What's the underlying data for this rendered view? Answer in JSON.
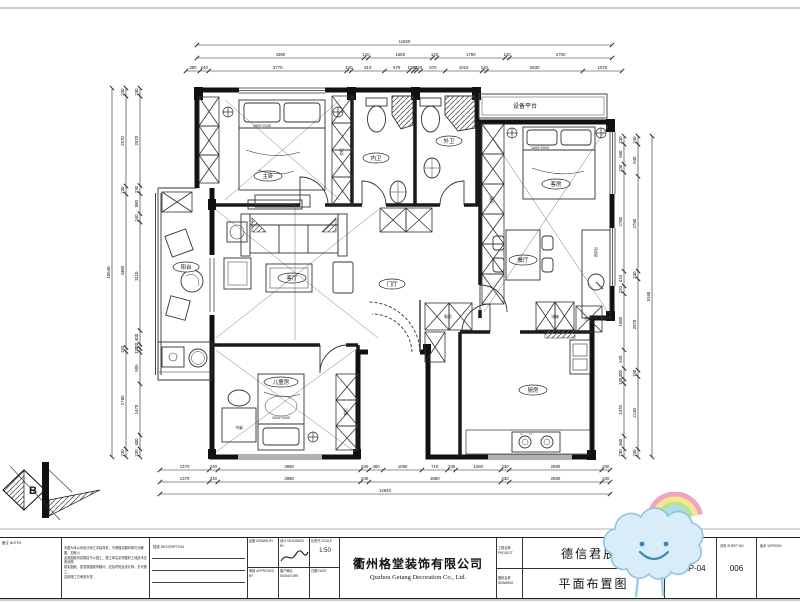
{
  "rooms": {
    "master": "主卧",
    "bath_in": "内卫",
    "bath_out": "外卫",
    "guest": "客房",
    "dining": "餐厅",
    "foyer": "门厅",
    "living": "客厅",
    "balcony": "阳台",
    "kids": "儿童房",
    "kitchen": "厨房",
    "equipment": "设备平台"
  },
  "furniture": {
    "master_bed_size": "1800*2100",
    "guest_bed_size": "1800*2000",
    "kids_bed_size": "1500*2000",
    "wardrobe": "衣柜",
    "desk": "书桌",
    "fridge": "冰箱",
    "shoe_cabinet": "鞋柜",
    "west_kitchen": "西厨台",
    "washer": "洗衣机"
  },
  "compass": {
    "letter": "B"
  },
  "dimensions": {
    "top": [
      [
        "11920"
      ],
      [
        "4390",
        "120",
        "1680",
        "120",
        "1790",
        "120",
        "2700"
      ],
      [
        "380",
        "240",
        "3770",
        "120",
        "910",
        "670",
        "120",
        "80",
        "120",
        "670",
        "1010",
        "120",
        "2630",
        "1070"
      ]
    ],
    "bottom": [
      [
        "1370",
        "240",
        "3980",
        "230",
        "400",
        "1080",
        "710",
        "230",
        "1260",
        "230",
        "2580",
        "230"
      ],
      [
        "1370",
        "240",
        "3980",
        "230",
        "3680",
        "230",
        "2580",
        "230"
      ],
      [
        "12540"
      ]
    ],
    "left": [
      [
        "230",
        "2570",
        "230",
        "580",
        "240",
        "3110",
        "400",
        "120",
        "110",
        "905",
        "1470",
        "400",
        "230"
      ],
      [
        "230",
        "2570",
        "230",
        "4380",
        "120",
        "2780",
        "230"
      ],
      [
        "10540"
      ]
    ],
    "right": [
      [
        "230",
        "560",
        "230",
        "2780",
        "410",
        "220",
        "1580",
        "520",
        "300",
        "130",
        "1470",
        "360",
        "230"
      ],
      [
        "240",
        "940",
        "2780",
        "230",
        "2670",
        "190",
        "2130",
        "230"
      ],
      [
        "9160"
      ]
    ]
  },
  "title_block": {
    "notes_label": "备注 NOTES",
    "notes_lines": [
      "本图为本公司设计师之手绘风采，不得随意翻印拷贝分解图，如有以",
      "此类图纸内容擅自予以施工，施工单位必须做好工地技术交底对照",
      "核实图纸，如发现图纸有疑问，应及时知会设计师，方可施工，",
      "否则施工方承担责任。"
    ],
    "description_label": "描述 DESCRIPTION",
    "drawn_label": "绘图 DRAWN BY",
    "designed_label": "设计 DESIGNED BY",
    "scale_label": "比例尺 SCALE",
    "scale_value": "1:50",
    "approved_label": "审核 APPROVED BY",
    "signature_label": "客户确认 SIGNATURE",
    "date_label": "日期 DATE",
    "company_cn": "衢州格堂装饰有限公司",
    "company_en": "Quzhou Getang Decoration Co., Ltd.",
    "project_label": "工程名称 PROJECT",
    "project_value": "德信君辰5",
    "drawing_label": "图纸名称 DRAWING",
    "drawing_value": "平面布置图",
    "dwg_no_label": "图号 DWG NO.",
    "dwg_no_value": "P-AP-04",
    "sheet_no_label": "页码 SHEET NO.",
    "sheet_no_value": "006",
    "version_label": "版本 VERSION"
  }
}
